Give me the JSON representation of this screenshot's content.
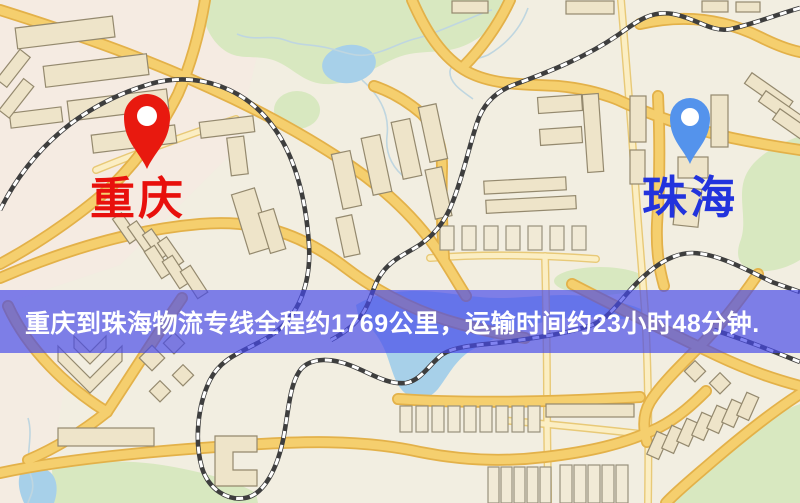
{
  "banner": {
    "text": "重庆到珠海物流专线全程约1769公里，运输时间约23小时48分钟.",
    "background_color": "rgba(70,72,235,0.68)",
    "text_color": "#ffffff",
    "distance_km": "1769",
    "duration": "23小时48分钟"
  },
  "map": {
    "origin": {
      "label": "重庆",
      "pin_color": "#e8190f",
      "label_color": "#e8100c"
    },
    "destination": {
      "label": "珠海",
      "pin_color": "#5493ec",
      "label_color": "#2233dd"
    },
    "colors": {
      "background": "#f2eee1",
      "road_fill": "#f5cf6e",
      "road_casing": "#e3b149",
      "park": "#d8e8c0",
      "water": "#a7d0e9",
      "building": "#eee4c9",
      "railway": "#3e3e3e"
    }
  }
}
